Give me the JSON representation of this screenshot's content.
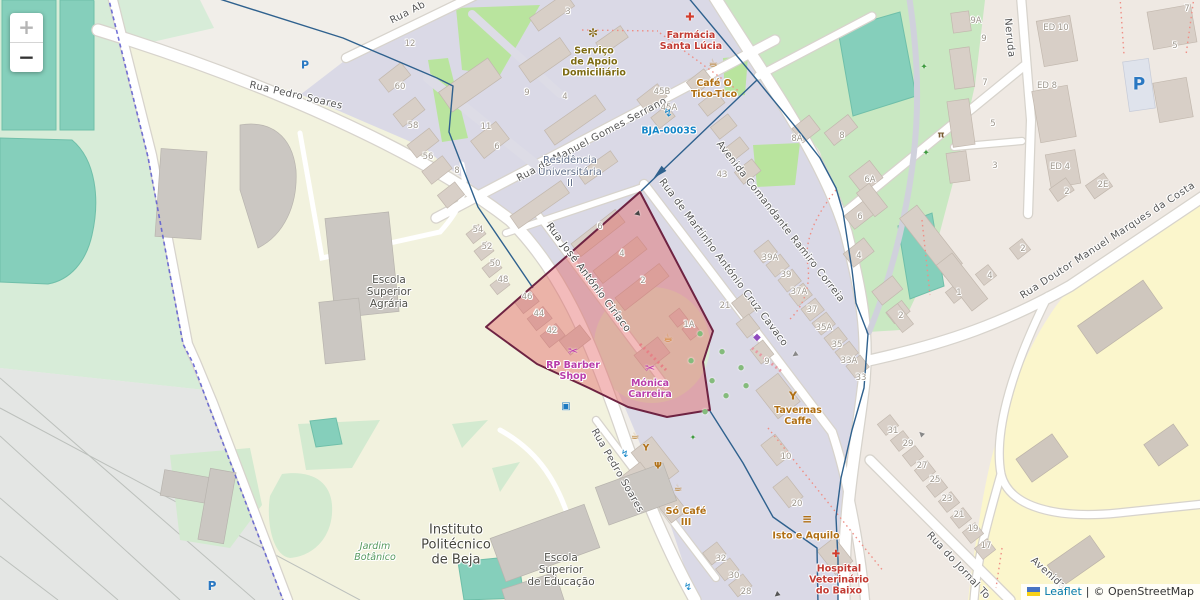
{
  "map": {
    "controls": {
      "zoom_in_label": "+",
      "zoom_out_label": "−"
    },
    "attribution": {
      "leaflet_link": "Leaflet",
      "separator": "|",
      "osm_credit": "© OpenStreetMap"
    },
    "highlight_polygon": {
      "fill": "#e25d5d",
      "stroke": "#6e2342",
      "opacity": 0.42
    },
    "route_color": "#2f618e",
    "labels": [
      {
        "cls": "street",
        "n": "street-rua-pedro-soares-north",
        "t": "Rua Pedro Soares",
        "x": 296,
        "y": 96,
        "r": 13
      },
      {
        "cls": "street",
        "n": "street-rua-pedro-soares-south",
        "t": "Rua Pedro Soares",
        "x": 617,
        "y": 471,
        "r": 60
      },
      {
        "cls": "street",
        "n": "street-rua-ab",
        "t": "Rua Ab",
        "x": 408,
        "y": 13,
        "r": -27
      },
      {
        "cls": "street",
        "n": "street-manuel-gomes-serrano",
        "t": "Rua de Manuel Gomes Serrano",
        "x": 592,
        "y": 140,
        "r": -28
      },
      {
        "cls": "street",
        "n": "street-martinho-cruz-cavaco",
        "t": "Rua de Martinho António Cruz Cavaco",
        "x": 723,
        "y": 263,
        "r": 53
      },
      {
        "cls": "street",
        "n": "street-avenida-ramiro-correia",
        "t": "Avenida Comandante Ramiro Correia",
        "x": 780,
        "y": 222,
        "r": 52
      },
      {
        "cls": "street",
        "n": "street-jose-antonio-ciriaco",
        "t": "Rua José António Ciríaco",
        "x": 588,
        "y": 278,
        "r": 53,
        "c": "#4a4a4a"
      },
      {
        "cls": "street",
        "n": "street-doutor-manuel-marques",
        "t": "Rua Doutor Manuel Marques da Costa",
        "x": 1108,
        "y": 241,
        "r": -33
      },
      {
        "cls": "street",
        "n": "street-rua-do-jornal",
        "t": "Rua do Jornal To",
        "x": 958,
        "y": 566,
        "r": 47
      },
      {
        "cls": "street",
        "n": "street-neruda",
        "t": "Neruda",
        "x": 1009,
        "y": 38,
        "r": 84
      },
      {
        "cls": "street",
        "n": "street-avenida-bottom",
        "t": "Avenida",
        "x": 1048,
        "y": 574,
        "r": 42
      },
      {
        "cls": "area",
        "n": "area-escola-superior-agraria",
        "lines": [
          "Escola",
          "Superior",
          "Agrária"
        ],
        "x": 389,
        "y": 292,
        "c": "#50504a",
        "s": 10.5
      },
      {
        "cls": "area",
        "n": "area-instituto-politecnico",
        "lines": [
          "Instituto",
          "Politécnico",
          "de Beja"
        ],
        "x": 456,
        "y": 546,
        "c": "#46463e",
        "s": 13
      },
      {
        "cls": "area",
        "n": "area-escola-superior-educacao",
        "lines": [
          "Escola",
          "Superior",
          "de Educação"
        ],
        "x": 561,
        "y": 570,
        "c": "#50504a",
        "s": 10.5
      },
      {
        "cls": "area",
        "n": "area-jardim-botanico",
        "lines": [
          "Jardim",
          "Botânico"
        ],
        "x": 375,
        "y": 553,
        "c": "#579a5f",
        "s": 9.5,
        "i": 1
      },
      {
        "cls": "area",
        "n": "area-residencia-universitaria",
        "lines": [
          "Residência",
          "Universitária",
          "II"
        ],
        "x": 570,
        "y": 172,
        "c": "#5f6d88",
        "s": 10
      },
      {
        "cls": "poi",
        "n": "poi-farmacia-santa-lucia",
        "lines": [
          "Farmácia",
          "Santa Lúcia"
        ],
        "x": 691,
        "y": 42,
        "c": "#c23b33"
      },
      {
        "cls": "poi",
        "n": "poi-cafe-o-tico-tico",
        "lines": [
          "Café O",
          "Tico-Tico"
        ],
        "x": 714,
        "y": 90,
        "c": "#b06f14"
      },
      {
        "cls": "poi",
        "n": "poi-servico-apoio-domiciliario",
        "lines": [
          "Serviço",
          "de Apoio",
          "Domiciliário"
        ],
        "x": 594,
        "y": 63,
        "c": "#7d6b13"
      },
      {
        "cls": "poi",
        "n": "poi-bja-0003s",
        "lines": [
          "BJA-0003S"
        ],
        "x": 669,
        "y": 132,
        "c": "#1385c7"
      },
      {
        "cls": "poi",
        "n": "poi-rp-barber-shop",
        "lines": [
          "RP Barber",
          "Shop"
        ],
        "x": 573,
        "y": 372,
        "c": "#b93daa"
      },
      {
        "cls": "poi",
        "n": "poi-monica-carreira",
        "lines": [
          "Mónica",
          "Carreira"
        ],
        "x": 650,
        "y": 390,
        "c": "#b93daa"
      },
      {
        "cls": "poi",
        "n": "poi-tavernas-caffe",
        "lines": [
          "Tavernas",
          "Caffe"
        ],
        "x": 798,
        "y": 417,
        "c": "#b06f14"
      },
      {
        "cls": "poi",
        "n": "poi-so-cafe-iii",
        "lines": [
          "Só Café",
          "III"
        ],
        "x": 686,
        "y": 518,
        "c": "#b06f14"
      },
      {
        "cls": "poi",
        "n": "poi-isto-e-aquilo",
        "lines": [
          "Isto e Aquilo"
        ],
        "x": 806,
        "y": 537,
        "c": "#b06f14"
      },
      {
        "cls": "poi",
        "n": "poi-hospital-veterinario",
        "lines": [
          "Hospital",
          "Veterinário",
          "do Baixo"
        ],
        "x": 839,
        "y": 581,
        "c": "#c23b33"
      },
      {
        "cls": "num",
        "t": "12",
        "x": 410,
        "y": 45
      },
      {
        "cls": "num",
        "t": "60",
        "x": 400,
        "y": 88
      },
      {
        "cls": "num",
        "t": "58",
        "x": 413,
        "y": 127
      },
      {
        "cls": "num",
        "t": "56",
        "x": 428,
        "y": 158
      },
      {
        "cls": "num",
        "t": "8",
        "x": 457,
        "y": 172
      },
      {
        "cls": "num",
        "t": "6",
        "x": 497,
        "y": 148
      },
      {
        "cls": "num",
        "t": "11",
        "x": 486,
        "y": 128
      },
      {
        "cls": "num",
        "t": "9",
        "x": 527,
        "y": 94
      },
      {
        "cls": "num",
        "t": "4",
        "x": 565,
        "y": 98
      },
      {
        "cls": "num",
        "t": "3",
        "x": 568,
        "y": 13
      },
      {
        "cls": "num",
        "t": "45B",
        "x": 662,
        "y": 93
      },
      {
        "cls": "num",
        "t": "45A",
        "x": 669,
        "y": 109
      },
      {
        "cls": "num",
        "t": "43",
        "x": 722,
        "y": 176
      },
      {
        "cls": "num",
        "t": "54",
        "x": 478,
        "y": 231
      },
      {
        "cls": "num",
        "t": "52",
        "x": 487,
        "y": 248
      },
      {
        "cls": "num",
        "t": "50",
        "x": 495,
        "y": 265
      },
      {
        "cls": "num",
        "t": "48",
        "x": 503,
        "y": 281
      },
      {
        "cls": "num",
        "t": "46",
        "x": 527,
        "y": 298
      },
      {
        "cls": "num",
        "t": "44",
        "x": 539,
        "y": 315
      },
      {
        "cls": "num",
        "t": "42",
        "x": 552,
        "y": 332
      },
      {
        "cls": "num",
        "t": "6",
        "x": 600,
        "y": 228
      },
      {
        "cls": "num",
        "t": "4",
        "x": 622,
        "y": 255
      },
      {
        "cls": "num",
        "t": "2",
        "x": 643,
        "y": 282
      },
      {
        "cls": "num",
        "t": "1A",
        "x": 689,
        "y": 326
      },
      {
        "cls": "num",
        "t": "21",
        "x": 725,
        "y": 307
      },
      {
        "cls": "num",
        "t": "39A",
        "x": 770,
        "y": 259
      },
      {
        "cls": "num",
        "t": "39",
        "x": 786,
        "y": 276
      },
      {
        "cls": "num",
        "t": "37A",
        "x": 799,
        "y": 293
      },
      {
        "cls": "num",
        "t": "37",
        "x": 812,
        "y": 311
      },
      {
        "cls": "num",
        "t": "35A",
        "x": 824,
        "y": 329
      },
      {
        "cls": "num",
        "t": "35",
        "x": 837,
        "y": 346
      },
      {
        "cls": "num",
        "t": "33A",
        "x": 849,
        "y": 362
      },
      {
        "cls": "num",
        "t": "33",
        "x": 861,
        "y": 379
      },
      {
        "cls": "num",
        "t": "9",
        "x": 767,
        "y": 363
      },
      {
        "cls": "num",
        "t": "10",
        "x": 786,
        "y": 458
      },
      {
        "cls": "num",
        "t": "20",
        "x": 797,
        "y": 505
      },
      {
        "cls": "num",
        "t": "32",
        "x": 721,
        "y": 560
      },
      {
        "cls": "num",
        "t": "30",
        "x": 734,
        "y": 577
      },
      {
        "cls": "num",
        "t": "28",
        "x": 746,
        "y": 593
      },
      {
        "cls": "num",
        "t": "31",
        "x": 893,
        "y": 432
      },
      {
        "cls": "num",
        "t": "29",
        "x": 908,
        "y": 445
      },
      {
        "cls": "num",
        "t": "27",
        "x": 922,
        "y": 467
      },
      {
        "cls": "num",
        "t": "25",
        "x": 935,
        "y": 481
      },
      {
        "cls": "num",
        "t": "23",
        "x": 947,
        "y": 500
      },
      {
        "cls": "num",
        "t": "21",
        "x": 959,
        "y": 516
      },
      {
        "cls": "num",
        "t": "19",
        "x": 973,
        "y": 530
      },
      {
        "cls": "num",
        "t": "17",
        "x": 986,
        "y": 547
      },
      {
        "cls": "num",
        "t": "8A",
        "x": 797,
        "y": 140
      },
      {
        "cls": "num",
        "t": "8",
        "x": 842,
        "y": 137
      },
      {
        "cls": "num",
        "t": "6A",
        "x": 870,
        "y": 181
      },
      {
        "cls": "num",
        "t": "6",
        "x": 860,
        "y": 218
      },
      {
        "cls": "num",
        "t": "4",
        "x": 859,
        "y": 257
      },
      {
        "cls": "num",
        "t": "2",
        "x": 901,
        "y": 317
      },
      {
        "cls": "num",
        "t": "1",
        "x": 959,
        "y": 294
      },
      {
        "cls": "num",
        "t": "4",
        "x": 990,
        "y": 277
      },
      {
        "cls": "num",
        "t": "2",
        "x": 1023,
        "y": 250
      },
      {
        "cls": "num",
        "t": "9A",
        "x": 976,
        "y": 22
      },
      {
        "cls": "num",
        "t": "9",
        "x": 984,
        "y": 40
      },
      {
        "cls": "num",
        "t": "7",
        "x": 985,
        "y": 84
      },
      {
        "cls": "num",
        "t": "5",
        "x": 993,
        "y": 125
      },
      {
        "cls": "num",
        "t": "3",
        "x": 995,
        "y": 167
      },
      {
        "cls": "num",
        "t": "2",
        "x": 1067,
        "y": 193
      },
      {
        "cls": "num",
        "t": "2E",
        "x": 1103,
        "y": 186
      },
      {
        "cls": "num",
        "t": "5",
        "x": 1175,
        "y": 47
      },
      {
        "cls": "num",
        "t": "7",
        "x": 1187,
        "y": 10
      },
      {
        "cls": "num",
        "t": "ED 10",
        "x": 1056,
        "y": 29
      },
      {
        "cls": "num",
        "t": "ED 8",
        "x": 1047,
        "y": 87
      },
      {
        "cls": "num",
        "t": "ED 4",
        "x": 1060,
        "y": 168
      }
    ],
    "icons": [
      {
        "n": "pharmacy-icon",
        "g": "✚",
        "x": 690,
        "y": 17,
        "c": "#d33c2c",
        "s": 11
      },
      {
        "n": "cafe-icon",
        "g": "☕",
        "x": 713,
        "y": 63,
        "c": "#b06f14",
        "s": 11
      },
      {
        "n": "social-facility-icon",
        "g": "✼",
        "x": 593,
        "y": 33,
        "c": "#8a6d1b",
        "s": 12
      },
      {
        "n": "charging-station-icon",
        "g": "↯",
        "x": 668,
        "y": 113,
        "c": "#1385c7",
        "s": 11
      },
      {
        "n": "hairdresser-icon",
        "g": "✂",
        "x": 573,
        "y": 351,
        "c": "#c13fae",
        "s": 12
      },
      {
        "n": "hairdresser-icon",
        "g": "✂",
        "x": 650,
        "y": 368,
        "c": "#c13fae",
        "s": 12
      },
      {
        "n": "cafe-icon",
        "g": "☕",
        "x": 668,
        "y": 338,
        "c": "#cf6f0e",
        "s": 11
      },
      {
        "n": "clothes-shop-icon",
        "g": "◆",
        "x": 757,
        "y": 338,
        "c": "#8f4bbf",
        "s": 10
      },
      {
        "n": "bar-icon",
        "g": "Y",
        "x": 793,
        "y": 396,
        "c": "#b06f14",
        "s": 11,
        "b": 1
      },
      {
        "n": "cafe-icon",
        "g": "☕",
        "x": 635,
        "y": 437,
        "c": "#b06f14",
        "s": 10
      },
      {
        "n": "bar-icon",
        "g": "Y",
        "x": 646,
        "y": 449,
        "c": "#b06f14",
        "s": 9,
        "b": 1
      },
      {
        "n": "restaurant-icon",
        "g": "Ψ",
        "x": 658,
        "y": 467,
        "c": "#b06f14",
        "s": 9,
        "b": 1
      },
      {
        "n": "cafe-icon",
        "g": "☕",
        "x": 678,
        "y": 489,
        "c": "#b06f14",
        "s": 10
      },
      {
        "n": "fast-food-icon",
        "g": "≡",
        "x": 807,
        "y": 519,
        "c": "#b06f14",
        "s": 12,
        "b": 1
      },
      {
        "n": "veterinary-icon",
        "g": "✚",
        "x": 836,
        "y": 555,
        "c": "#d33c2c",
        "s": 10
      },
      {
        "n": "charging-station-icon",
        "g": "↯",
        "x": 625,
        "y": 455,
        "c": "#1385c7",
        "s": 10
      },
      {
        "n": "charging-station-icon",
        "g": "↯",
        "x": 688,
        "y": 588,
        "c": "#1385c7",
        "s": 10
      },
      {
        "n": "bus-stop-icon",
        "g": "▣",
        "x": 566,
        "y": 407,
        "c": "#1c7ac1",
        "s": 10
      },
      {
        "n": "parking-icon",
        "g": "P",
        "x": 305,
        "y": 65,
        "c": "#2a78c2",
        "s": 11,
        "b": 1
      },
      {
        "n": "parking-icon",
        "g": "P",
        "x": 212,
        "y": 586,
        "c": "#2a78c2",
        "s": 12,
        "b": 1
      },
      {
        "n": "parking-icon",
        "g": "P",
        "x": 1139,
        "y": 85,
        "c": "#2a78c2",
        "s": 17,
        "b": 1
      },
      {
        "n": "runner-icon",
        "g": "✦",
        "x": 924,
        "y": 68,
        "c": "#3f9b3f",
        "s": 9
      },
      {
        "n": "runner-icon",
        "g": "✦",
        "x": 926,
        "y": 154,
        "c": "#3f9b3f",
        "s": 9
      },
      {
        "n": "picnic-icon",
        "g": "π",
        "x": 941,
        "y": 136,
        "c": "#7a5c33",
        "s": 9,
        "b": 1
      },
      {
        "n": "playground-icon",
        "g": "✦",
        "x": 693,
        "y": 438,
        "c": "#3f9b3f",
        "s": 8
      },
      {
        "n": "tree-icon",
        "g": "●",
        "x": 700,
        "y": 334,
        "c": "#84bb7c",
        "s": 7
      },
      {
        "n": "tree-icon",
        "g": "●",
        "x": 722,
        "y": 352,
        "c": "#84bb7c",
        "s": 7
      },
      {
        "n": "tree-icon",
        "g": "●",
        "x": 741,
        "y": 368,
        "c": "#84bb7c",
        "s": 7
      },
      {
        "n": "tree-icon",
        "g": "●",
        "x": 712,
        "y": 381,
        "c": "#84bb7c",
        "s": 7
      },
      {
        "n": "tree-icon",
        "g": "●",
        "x": 691,
        "y": 361,
        "c": "#84bb7c",
        "s": 7
      },
      {
        "n": "tree-icon",
        "g": "●",
        "x": 726,
        "y": 396,
        "c": "#84bb7c",
        "s": 7
      },
      {
        "n": "tree-icon",
        "g": "●",
        "x": 746,
        "y": 386,
        "c": "#84bb7c",
        "s": 7
      },
      {
        "n": "tree-icon",
        "g": "●",
        "x": 705,
        "y": 412,
        "c": "#84bb7c",
        "s": 7
      },
      {
        "n": "oneway-arrow-icon",
        "g": "◀",
        "x": 637,
        "y": 214,
        "c": "#444444",
        "s": 7,
        "r": -15
      },
      {
        "n": "oneway-arrow-icon",
        "g": "◀",
        "x": 795,
        "y": 355,
        "c": "#888888",
        "s": 7,
        "r": -35
      },
      {
        "n": "oneway-arrow-icon",
        "g": "◀",
        "x": 777,
        "y": 595,
        "c": "#555555",
        "s": 7,
        "r": -40
      },
      {
        "n": "oneway-arrow-icon",
        "g": "◀",
        "x": 921,
        "y": 434,
        "c": "#888888",
        "s": 7,
        "r": 45
      }
    ]
  }
}
